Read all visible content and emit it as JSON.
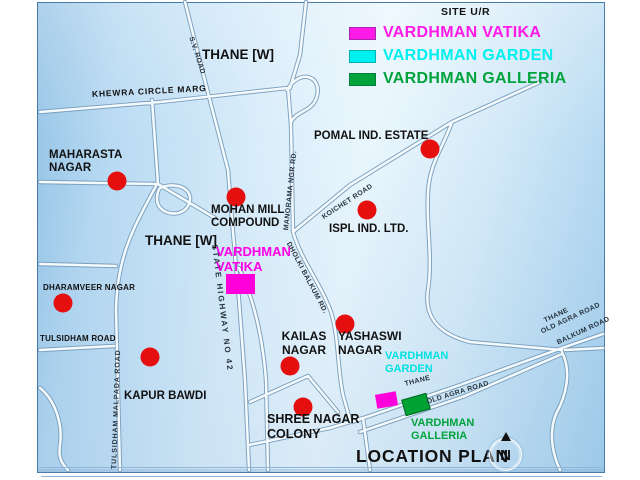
{
  "site_ref": "SITE U/R",
  "legend": {
    "items": [
      {
        "label": "VARDHMAN VATIKA",
        "color": "#ff1ae8"
      },
      {
        "label": "VARDHMAN GARDEN",
        "color": "#00f0f0"
      },
      {
        "label": "VARDHMAN GALLERIA",
        "color": "#00a33c"
      }
    ]
  },
  "places": {
    "thane_top": "THANE [W]",
    "khewra": "KHEWRA CIRCLE MARG",
    "maharasta": "MAHARASTA\nNAGAR",
    "pomal": "POMAL IND. ESTATE",
    "mohan": "MOHAN MILL\nCOMPOUND",
    "ispl": "ISPL IND. LTD.",
    "thane_mid": "THANE [W]",
    "vatika": "VARDHMAN\nVATIKA",
    "dharamveer": "DHARAMVEER NAGAR",
    "tulsidham": "TULSIDHAM ROAD",
    "kapur": "KAPUR BAWDI",
    "kailas": "KAILAS\nNAGAR",
    "yashaswi": "YASHASWI\nNAGAR",
    "garden": "VARDHMAN\nGARDEN",
    "shree": "SHREE NAGAR\nCOLONY",
    "galleria": "VARDHMAN\nGALLERIA"
  },
  "roads": {
    "sv": "S.V. ROAD",
    "manorama": "MANORAMA NGR RD.",
    "koichet": "KOICHET ROAD",
    "dholki": "DHOLKI BALKUM RD.",
    "highway": "STATE HIGHWAY NO 42",
    "malpada": "TULSIDHAM MALPADA ROAD",
    "thane_small": "THANE",
    "old_agra_1": "OLD AGRA ROAD",
    "thane_right": "THANE",
    "old_agra_2": "OLD AGRA ROAD",
    "balkum": "BALKUM ROAD"
  },
  "footer": {
    "title": "LOCATION PLAN",
    "compass": "N"
  },
  "colors": {
    "marker": "#e60f0f",
    "vatika_site": "#ff00dd",
    "garden_site": "#ff00dd",
    "galleria_site": "#00a233"
  }
}
